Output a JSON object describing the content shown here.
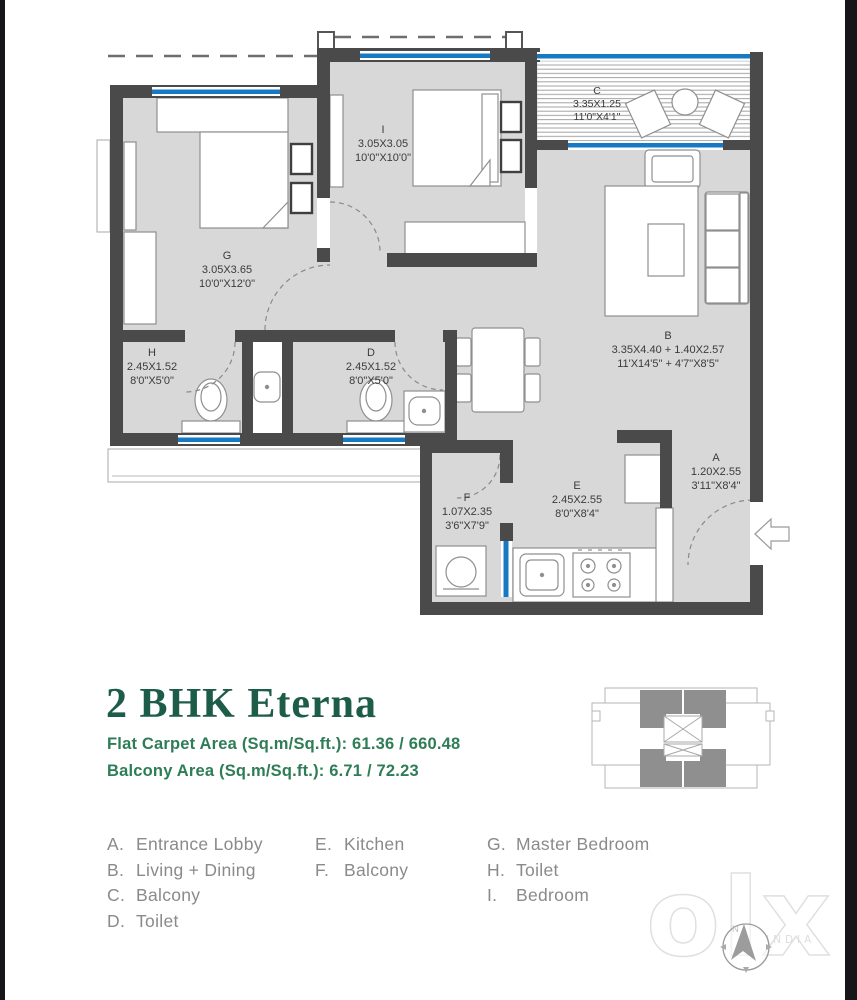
{
  "title_block": {
    "title": "2 BHK Eterna",
    "carpet_area": "Flat Carpet Area (Sq.m/Sq.ft.): 61.36 / 660.48",
    "balcony_area": "Balcony Area (Sq.m/Sq.ft.):  6.71 / 72.23",
    "title_color": "#1d5c49",
    "area_color": "#2e7d56"
  },
  "plan": {
    "rooms": {
      "A": {
        "letter": "A",
        "metric": "1.20X2.55",
        "imperial": "3'11\"X8'4\""
      },
      "B": {
        "letter": "B",
        "metric": "3.35X4.40 + 1.40X2.57",
        "imperial": "11'X14'5\" + 4'7\"X8'5\""
      },
      "C": {
        "letter": "C",
        "metric": "3.35X1.25",
        "imperial": "11'0\"X4'1\""
      },
      "D": {
        "letter": "D",
        "metric": "2.45X1.52",
        "imperial": "8'0\"X5'0\""
      },
      "E": {
        "letter": "E",
        "metric": "2.45X2.55",
        "imperial": "8'0\"X8'4\""
      },
      "F": {
        "letter": "F",
        "metric": "1.07X2.35",
        "imperial": "3'6\"X7'9\""
      },
      "G": {
        "letter": "G",
        "metric": "3.05X3.65",
        "imperial": "10'0\"X12'0\""
      },
      "H": {
        "letter": "H",
        "metric": "2.45X1.52",
        "imperial": "8'0\"X5'0\""
      },
      "I": {
        "letter": "I",
        "metric": "3.05X3.05",
        "imperial": "10'0\"X10'0\""
      }
    },
    "colors": {
      "wall": "#4a4a4a",
      "room_fill": "#d8d8d8",
      "window_blue": "#1779c4"
    }
  },
  "legend": {
    "col1": [
      {
        "key": "A.",
        "label": "Entrance Lobby"
      },
      {
        "key": "B.",
        "label": "Living + Dining"
      },
      {
        "key": "C.",
        "label": "Balcony"
      },
      {
        "key": "D.",
        "label": "Toilet"
      }
    ],
    "col2": [
      {
        "key": "E.",
        "label": "Kitchen"
      },
      {
        "key": "F.",
        "label": "Balcony"
      }
    ],
    "col3": [
      {
        "key": "G.",
        "label": "Master Bedroom"
      },
      {
        "key": "H.",
        "label": "Toilet"
      },
      {
        "key": "I.",
        "label": "Bedroom"
      }
    ]
  },
  "watermark": {
    "text": "olx",
    "subtext": "INDIA"
  },
  "compass": {
    "label": "N"
  }
}
